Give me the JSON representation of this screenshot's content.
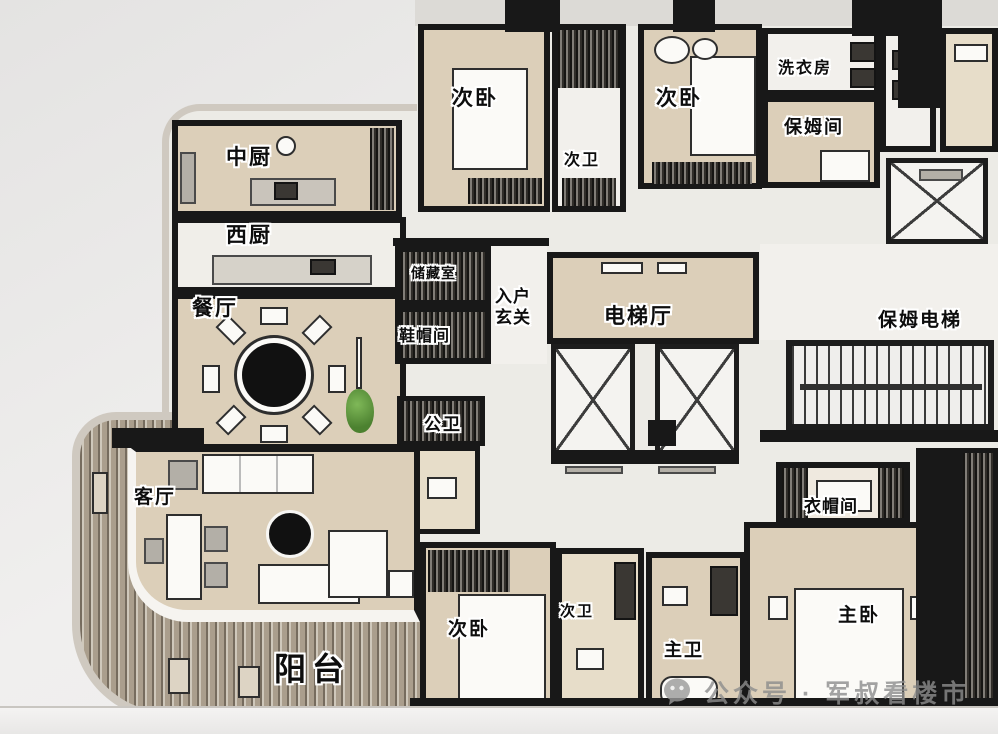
{
  "palette": {
    "wall": "#181818",
    "floor": "#dccfb9",
    "floor-light": "#f2f0ec",
    "wood": "#bdb3a1",
    "plant-green": "#5f9a43",
    "background": "#eeedec"
  },
  "labels": {
    "bedroom_top_left": "次卧",
    "bath_top": "次卫",
    "bedroom_top_mid": "次卧",
    "laundry": "洗衣房",
    "nanny_room": "保姆间",
    "chinese_kitchen": "中厨",
    "western_kitchen": "西厨",
    "dining_room": "餐厅",
    "storage_room": "储藏室",
    "entry_foyer": "入户玄关",
    "shoe_room": "鞋帽间",
    "elevator_hall": "电梯厅",
    "service_elevator": "保姆电梯",
    "public_bath": "公卫",
    "living_room": "客厅",
    "cloak_room": "衣帽间",
    "bedroom_bottom": "次卧",
    "bath_bottom": "次卫",
    "master_bath": "主卫",
    "master_bedroom": "主卧",
    "balcony": "阳台"
  },
  "watermark": {
    "icon": "wechat-icon",
    "text": "公众号 · 军叔看楼市"
  }
}
